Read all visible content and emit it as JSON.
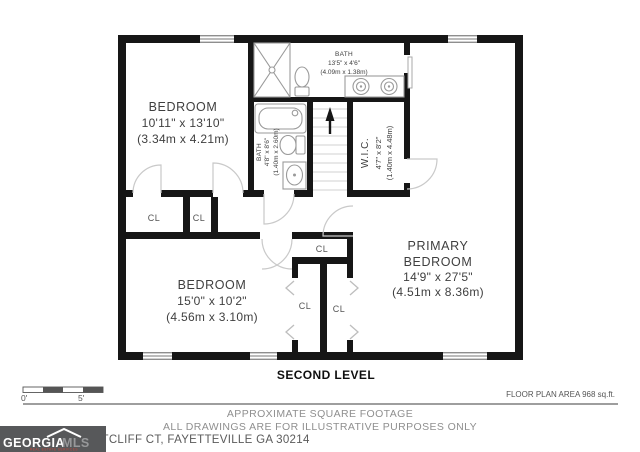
{
  "rooms": {
    "bedroom_top": {
      "name": "BEDROOM",
      "dims": "10'11\" x 13'10\"",
      "metric": "(3.34m x 4.21m)"
    },
    "bath_top": {
      "name": "BATH",
      "dims": "13'5\" x 4'6\"",
      "metric": "(4.09m x 1.38m)"
    },
    "bath_hall": {
      "name": "BATH",
      "dims": "4'8\" x 8'6\"",
      "metric": "(1.40m x 2.60m)"
    },
    "wic": {
      "name": "W.I.C.",
      "dims": "4'7\" x 8'2\"",
      "metric": "(1.40m x 4.48m)"
    },
    "bedroom_bottom": {
      "name": "BEDROOM",
      "dims": "15'0\" x 10'2\"",
      "metric": "(4.56m x 3.10m)"
    },
    "primary": {
      "name_line1": "PRIMARY",
      "name_line2": "BEDROOM",
      "dims": "14'9\" x 27'5\"",
      "metric": "(4.51m x 8.36m)"
    }
  },
  "closet_label": "CL",
  "plan": {
    "level": "SECOND LEVEL",
    "area_note": "FLOOR PLAN AREA 968 sq.ft."
  },
  "scale": {
    "zero": "0'",
    "five": "5'"
  },
  "disclaimer": {
    "line1": "APPROXIMATE SQUARE FOOTAGE",
    "line2": "ALL DRAWINGS ARE FOR ILLUSTRATIVE PURPOSES ONLY"
  },
  "address": "ITCLIFF CT, FAYETTEVILLE GA 30214",
  "logo": {
    "name_part1": "GEORGIA",
    "name_part2": "MLS",
    "tagline": "REAL ESTATE SERVICES"
  },
  "colors": {
    "wall": "#161616",
    "fixture": "#9a9a9a",
    "door_arc": "#c9c9c9",
    "label": "#3f3f3f",
    "footer_text": "#8f8f8f",
    "logo_bg": "#57585a",
    "logo_mls": "#97989a",
    "logo_tagline": "#cc4437"
  }
}
